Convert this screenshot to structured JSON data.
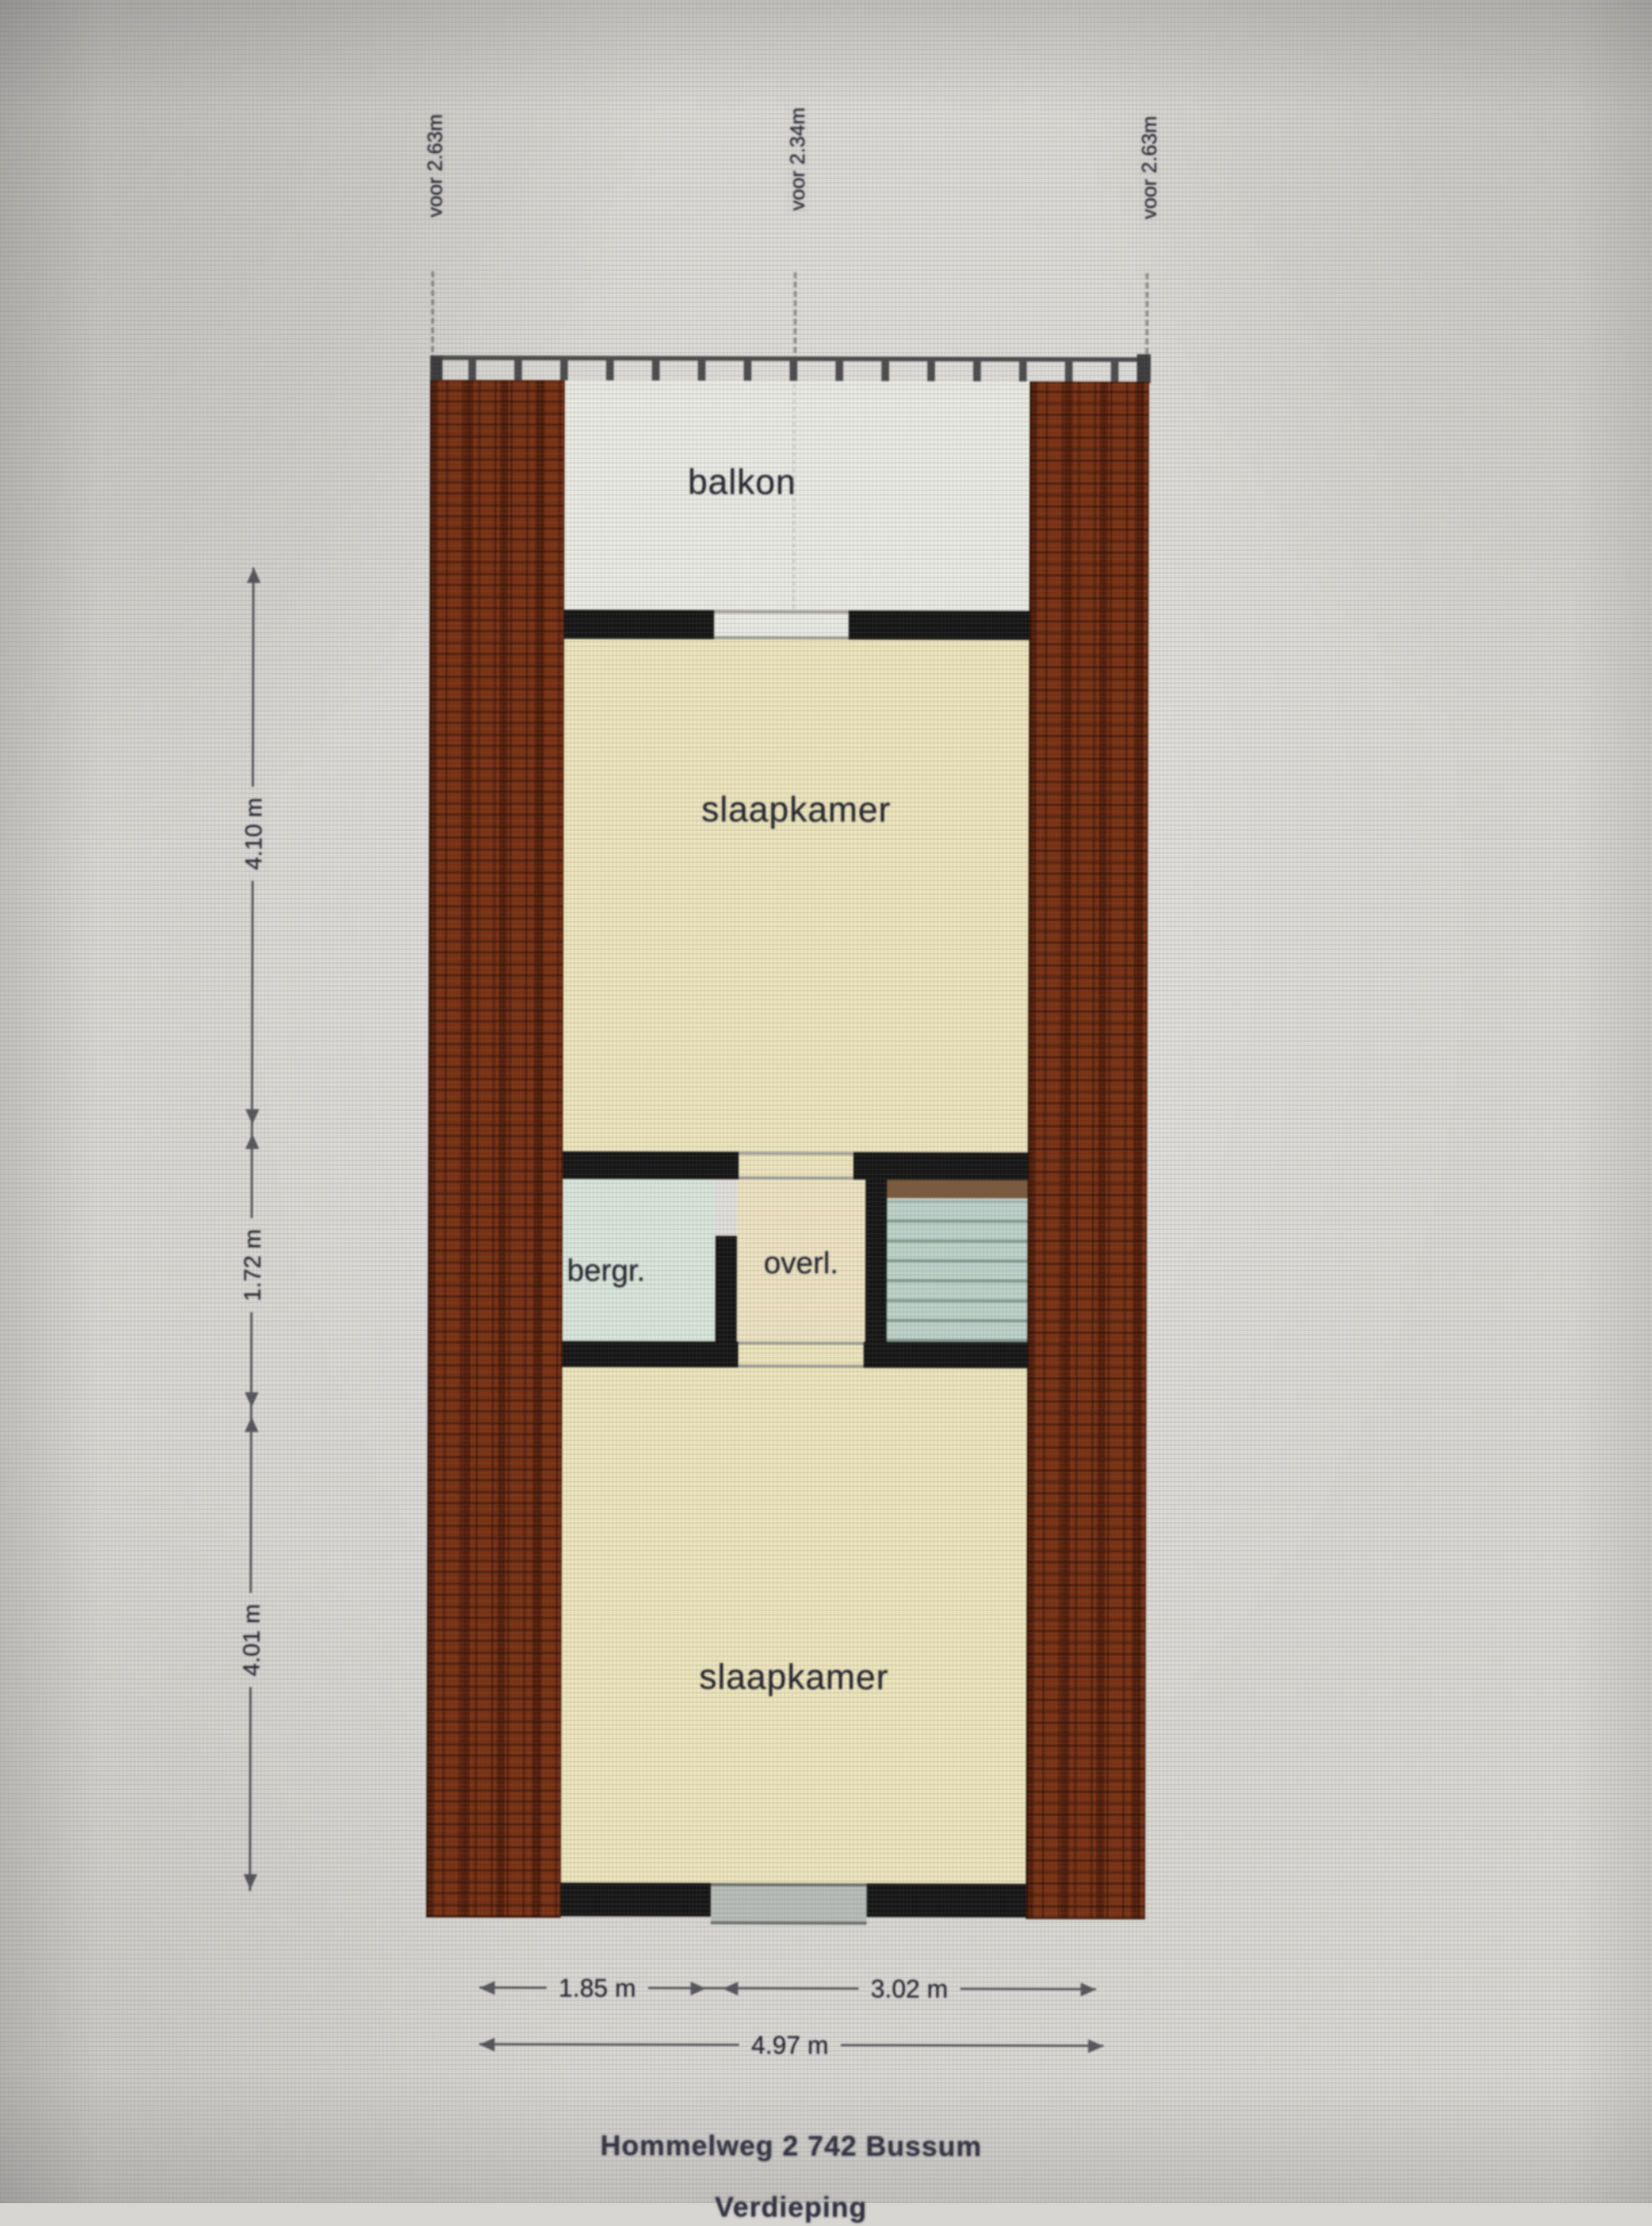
{
  "plan": {
    "top_labels": [
      "voor 2.63m",
      "voor 2.34m",
      "voor 2.63m"
    ],
    "rooms": {
      "balkon": "balkon",
      "slaapkamer_boven": "slaapkamer",
      "bergr": "bergr.",
      "overl": "overl.",
      "slaapkamer_onder": "slaapkamer"
    },
    "dims_left": [
      "4.10 m",
      "1.72 m",
      "4.01 m"
    ],
    "dims_bottom": [
      "1.85 m",
      "3.02 m"
    ],
    "dim_total": "4.97 m",
    "caption": {
      "line1": "Hommelweg 2 742 Bussum",
      "line2": "Verdieping"
    },
    "colors": {
      "background": "#d8d6d2",
      "brick_wall": "#7a3113",
      "interior_wall": "#161616",
      "floor_bedroom": "#ece4bc",
      "floor_balcony": "#e9e9e3",
      "floor_storage": "#d8e5da",
      "floor_landing": "#ece2c2",
      "stairwell": "#bdd1c9",
      "bottom_window": "#b8bdb9",
      "dimension_line": "#55555c"
    }
  }
}
